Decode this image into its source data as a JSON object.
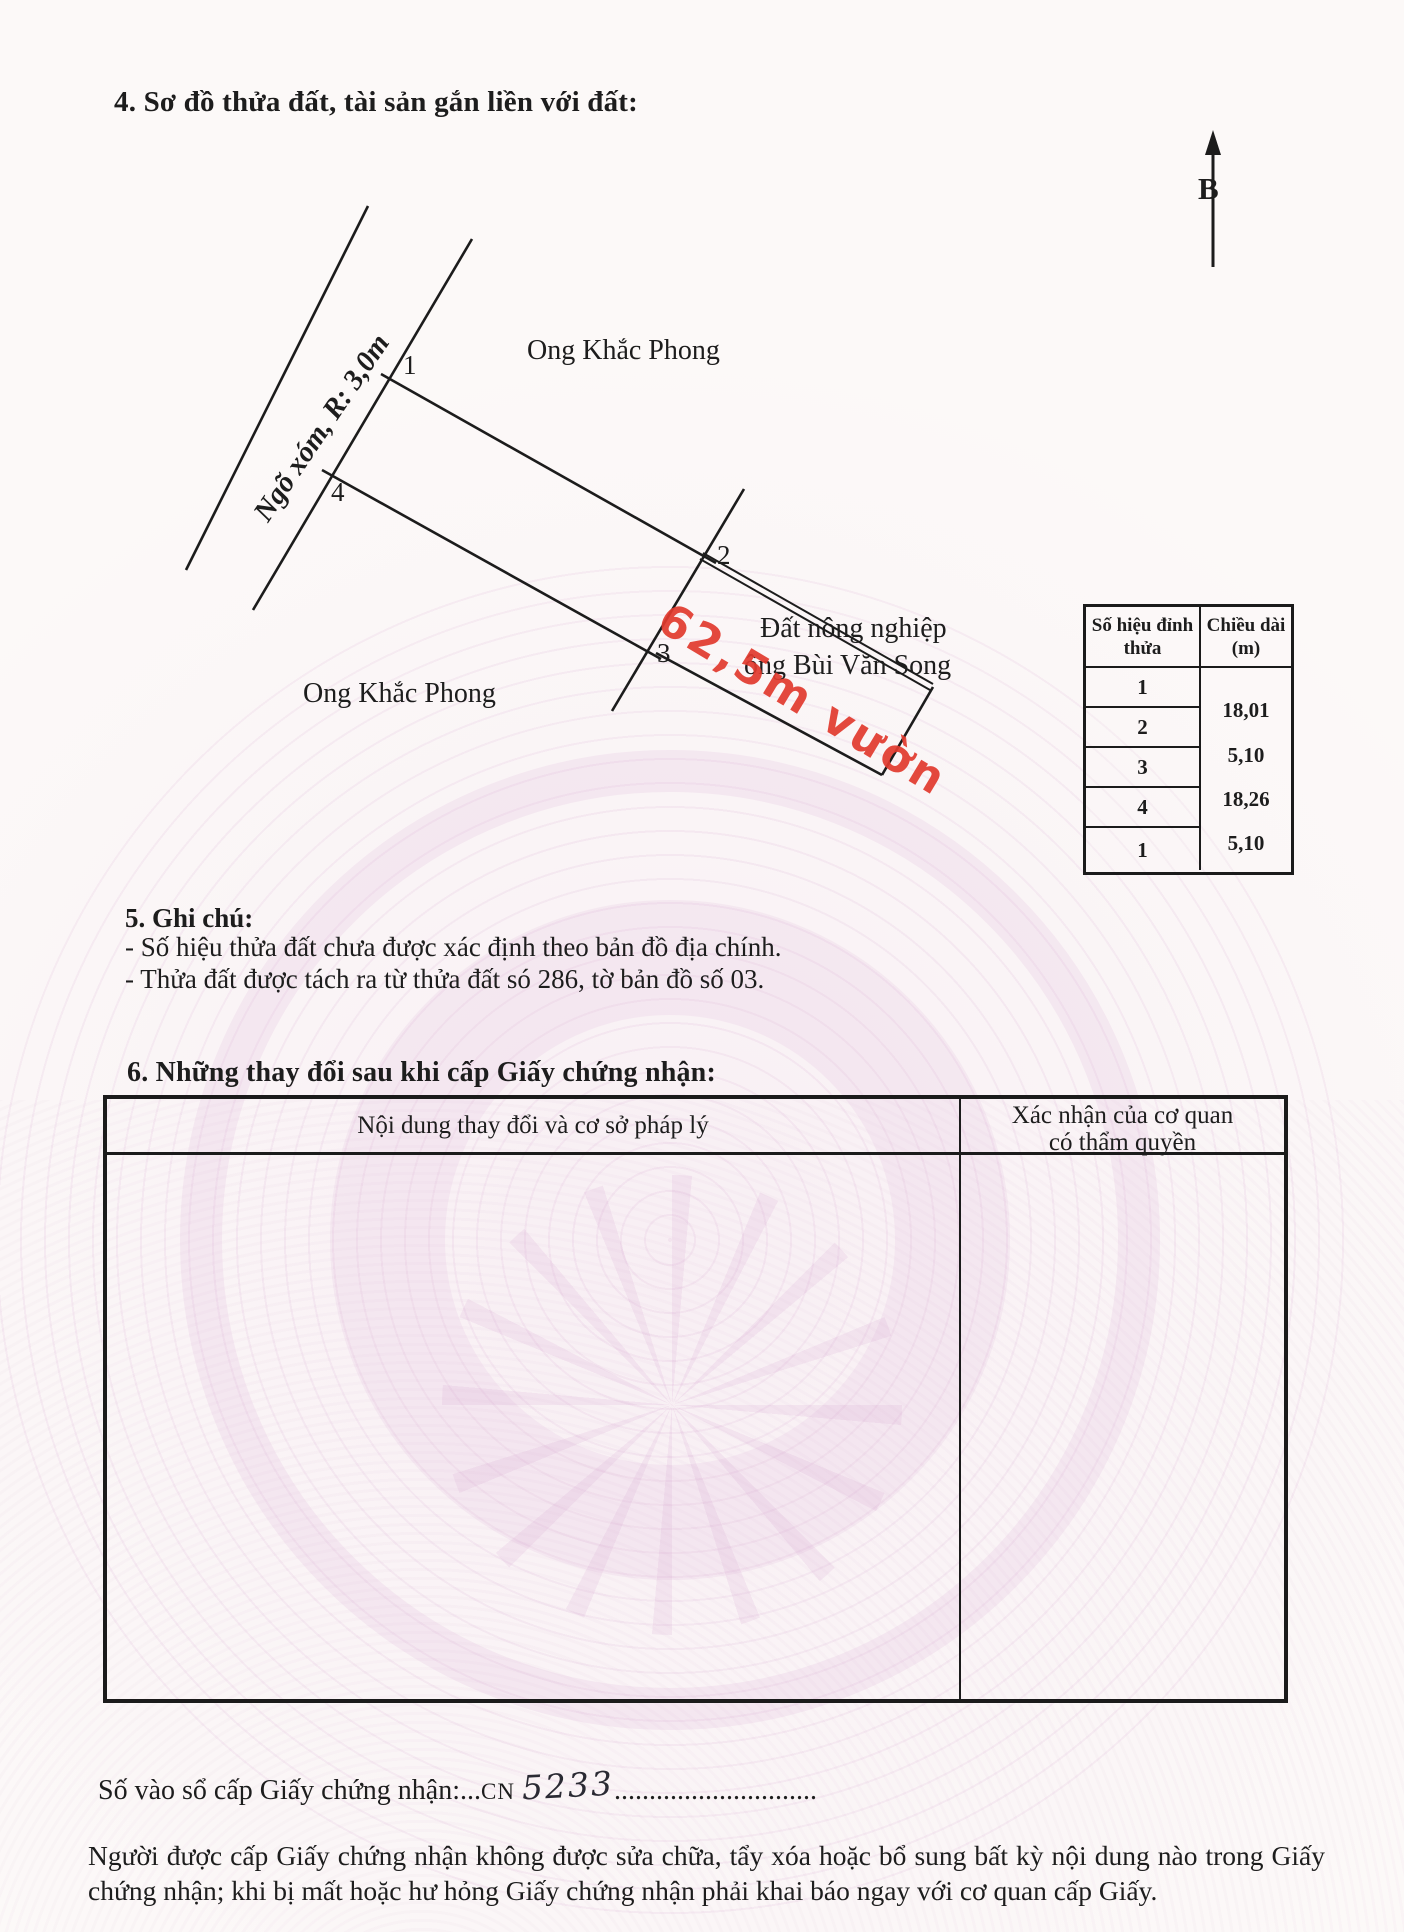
{
  "section4": {
    "title": "4. Sơ đồ thửa đất, tài sản gắn liền với đất:"
  },
  "north": {
    "label": "B"
  },
  "diagram": {
    "road_label": "Ngõ xóm, R: 3,0m",
    "neighbor_top": "Ong Khắc Phong",
    "neighbor_left": "Ong Khắc Phong",
    "neighbor_right_line1": "Đất nông nghiệp",
    "neighbor_right_line2": "ông Bùi Văn Song",
    "red_note": "62,5m vườn",
    "vertex_labels": [
      "1",
      "2",
      "3",
      "4"
    ]
  },
  "vertex_table": {
    "header_col1_line1": "Số hiệu đỉnh",
    "header_col1_line2": "thửa",
    "header_col2_line1": "Chiều dài",
    "header_col2_line2": "(m)",
    "vertices": [
      "1",
      "2",
      "3",
      "4",
      "1"
    ],
    "lengths": [
      "18,01",
      "5,10",
      "18,26",
      "5,10"
    ]
  },
  "section5": {
    "title": "5. Ghi chú:",
    "line1": "- Số hiệu thửa đất chưa được xác định theo bản đồ địa chính.",
    "line2": "- Thửa đất được tách ra từ thửa đất só 286, tờ bản đồ số 03."
  },
  "section6": {
    "title": "6. Những thay đổi sau khi cấp Giấy chứng nhận:",
    "col1_header": "Nội dung thay đổi và cơ sở pháp lý",
    "col2_header_line1": "Xác nhận của cơ quan",
    "col2_header_line2": "có thẩm quyền"
  },
  "footer": {
    "register_label": "Số vào sổ cấp Giấy chứng nhận:",
    "register_dots_pre": "...",
    "register_code": "CN",
    "register_number": "5233",
    "register_dots_post": ".............................",
    "note_paragraph": "Người được cấp Giấy chứng nhận không được sửa chữa, tẩy xóa hoặc bổ sung bất kỳ nội dung nào trong Giấy chứng nhận; khi bị mất hoặc hư hỏng Giấy chứng nhận phải khai báo ngay với cơ quan cấp Giấy."
  },
  "colors": {
    "ink": "#1d1d1d",
    "line": "#1c1c1c",
    "red_annotation": "#e23a2e",
    "watermark_pink": "#e7c9e2",
    "paper": "#fcf9f8"
  }
}
